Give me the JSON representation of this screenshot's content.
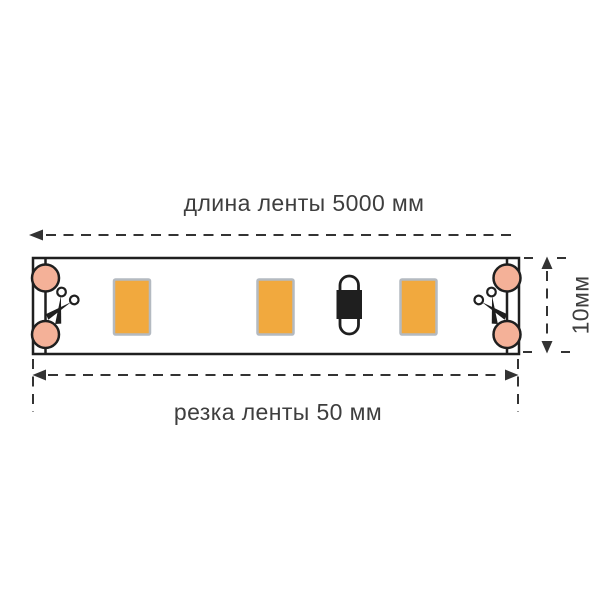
{
  "diagram": {
    "title_top": "длина ленты 5000 мм",
    "label_bottom": "резка ленты 50 мм",
    "label_right": "10мм",
    "strip": {
      "visible_leds": 3,
      "visible_resistors": 1,
      "solder_pads": 4,
      "cut_marks": 2
    },
    "icons": {
      "scissors": "scissors-icon",
      "arrow_left": "arrow-left-icon",
      "arrow_right": "arrow-right-icon",
      "arrow_up": "arrow-up-icon",
      "arrow_down": "arrow-down-icon"
    }
  },
  "colors": {
    "pad": "#f4b198",
    "led": "#f1a93e",
    "led_border": "#b4bac1",
    "line": "#1f1f1f",
    "dim_line": "#333333",
    "text": "#3e3e3e",
    "background": "#ffffff"
  }
}
